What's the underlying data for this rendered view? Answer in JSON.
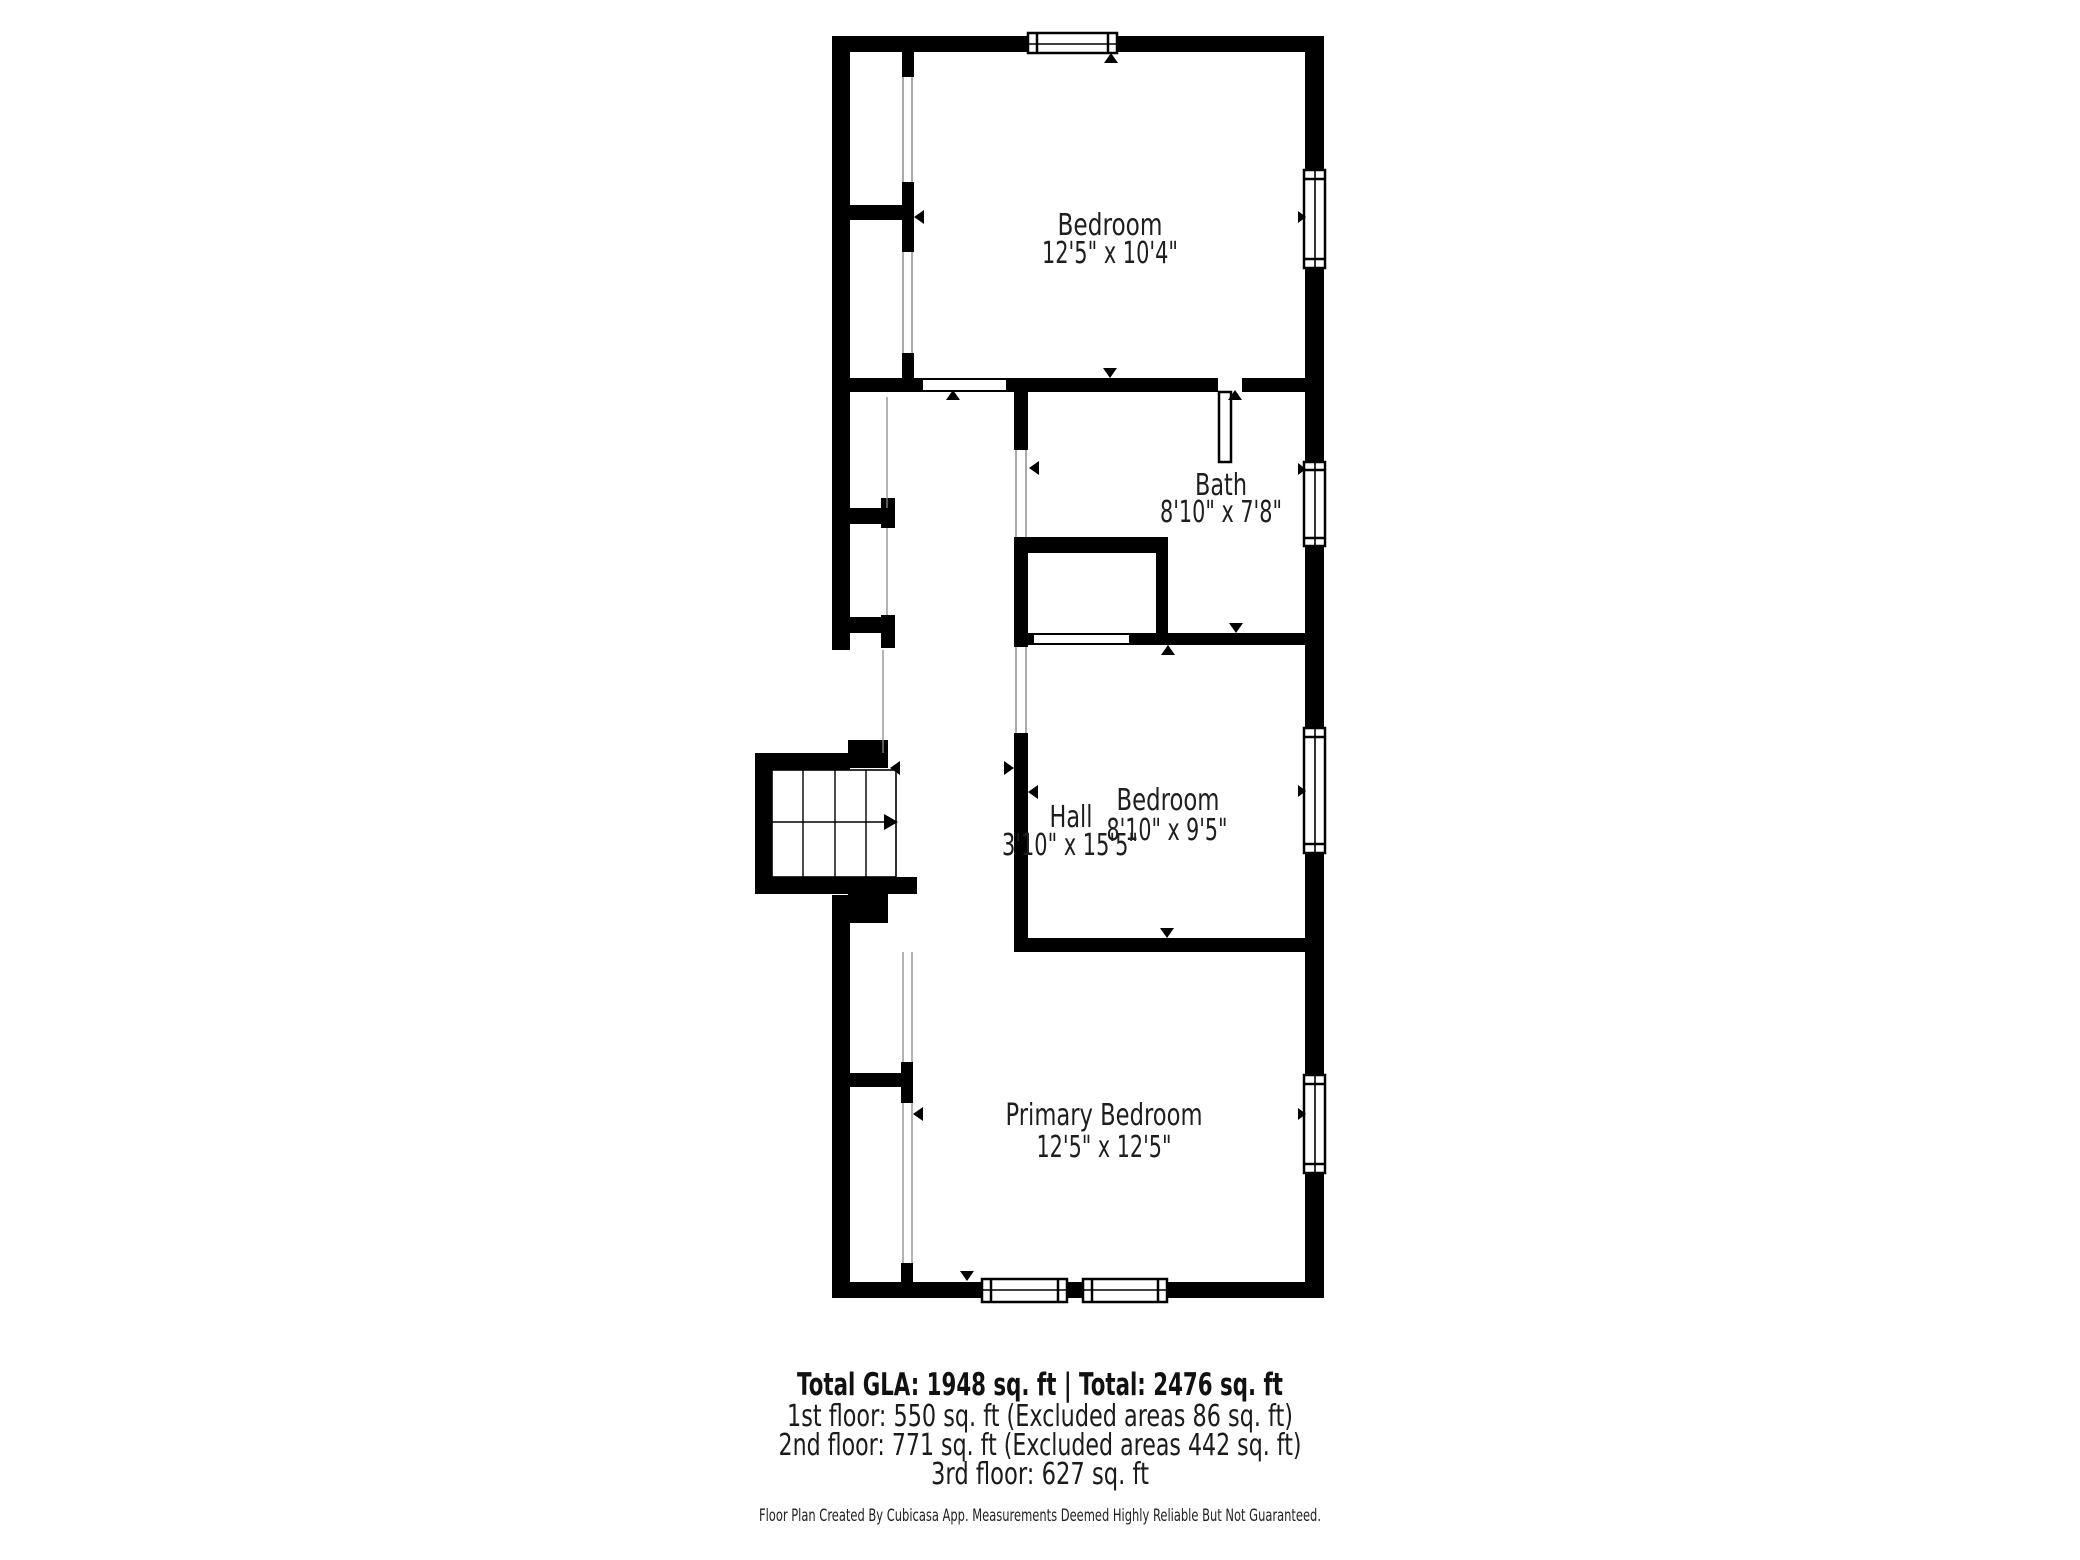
{
  "plan": {
    "type": "floor-plan",
    "rooms": [
      {
        "name": "Bedroom",
        "dimensions": "12'5\" x 10'4\""
      },
      {
        "name": "Bath",
        "dimensions": "8'10\" x 7'8\""
      },
      {
        "name": "Hall",
        "dimensions": "3'10\" x 15'5\""
      },
      {
        "name": "Bedroom",
        "dimensions": "8'10\" x 9'5\""
      },
      {
        "name": "Primary Bedroom",
        "dimensions": "12'5\" x 12'5\""
      }
    ],
    "colors": {
      "wall": "#000000",
      "text": "#1e1e1e",
      "background": "#ffffff",
      "thin_line": "#8a8a8a"
    }
  },
  "summary": {
    "total_line": "Total GLA: 1948 sq. ft | Total: 2476 sq. ft",
    "floors": [
      "1st floor: 550 sq. ft (Excluded areas 86 sq. ft)",
      "2nd floor: 771 sq. ft (Excluded areas 442 sq. ft)",
      "3rd floor: 627 sq. ft"
    ],
    "disclaimer": "Floor Plan Created By Cubicasa App. Measurements Deemed Highly Reliable But Not Guaranteed."
  }
}
